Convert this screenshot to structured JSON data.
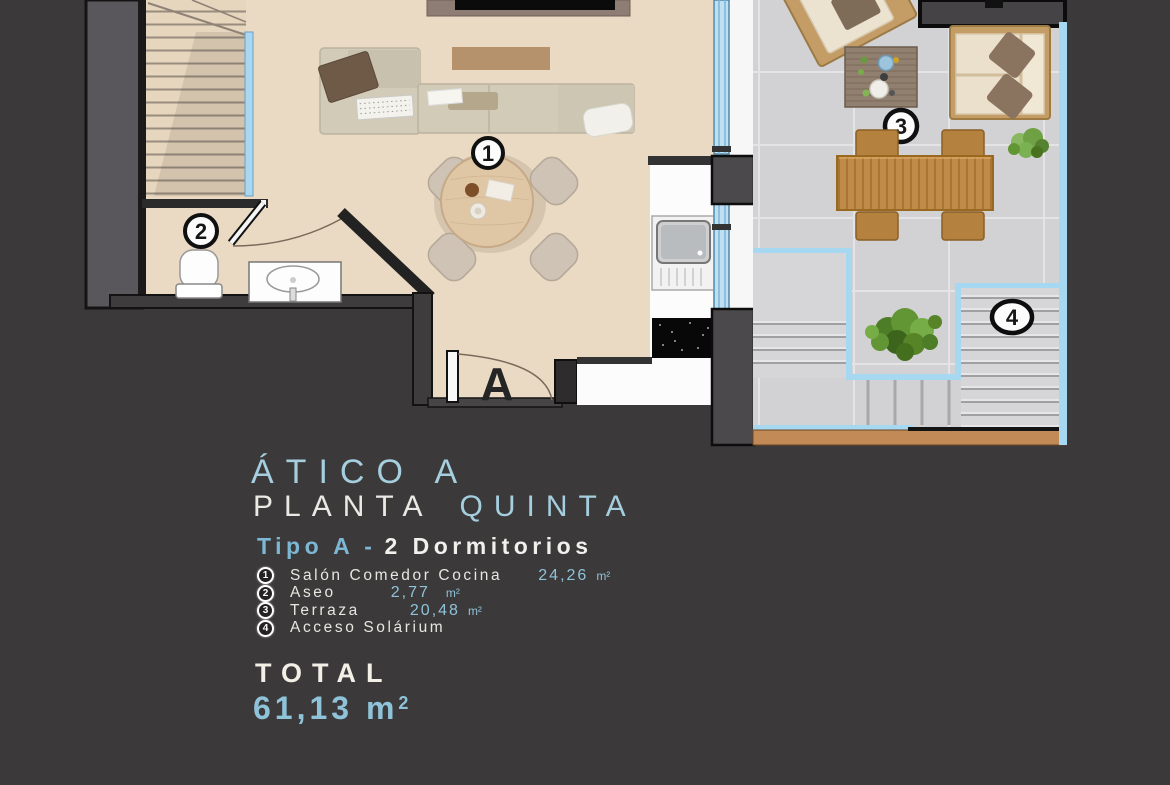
{
  "floor_plan": {
    "rooms": {
      "living_label": "1",
      "aseo_label": "2",
      "terraza_label": "3",
      "solarium_label": "4",
      "entrance_letter": "A"
    }
  },
  "heading": {
    "title": "ÁTICO A",
    "subtitle_white": "PLANTA",
    "subtitle_blue": "QUINTA",
    "type_blue": "Tipo A -",
    "type_white": "2 Dormitorios"
  },
  "legend": {
    "items": [
      {
        "num": "1",
        "label": "Salón Comedor Cocina",
        "area": "24,26",
        "unit": "m²"
      },
      {
        "num": "2",
        "label": "Aseo",
        "area": "2,77",
        "unit": "m²"
      },
      {
        "num": "3",
        "label": "Terraza",
        "area": "20,48",
        "unit": "m²"
      },
      {
        "num": "4",
        "label": "Acceso Solárium",
        "area": "",
        "unit": ""
      }
    ]
  },
  "total": {
    "label": "TOTAL",
    "value": "61,13 m",
    "sup": "2"
  },
  "colors": {
    "background": "#3b393a",
    "accent_blue": "#8fc3d9",
    "text_white": "#f0ede5",
    "floor_beige": "#ead9c3",
    "terrace_gray": "#d2d1d3",
    "glass_blue": "#a7d8f2",
    "wood": "#c08a48"
  }
}
